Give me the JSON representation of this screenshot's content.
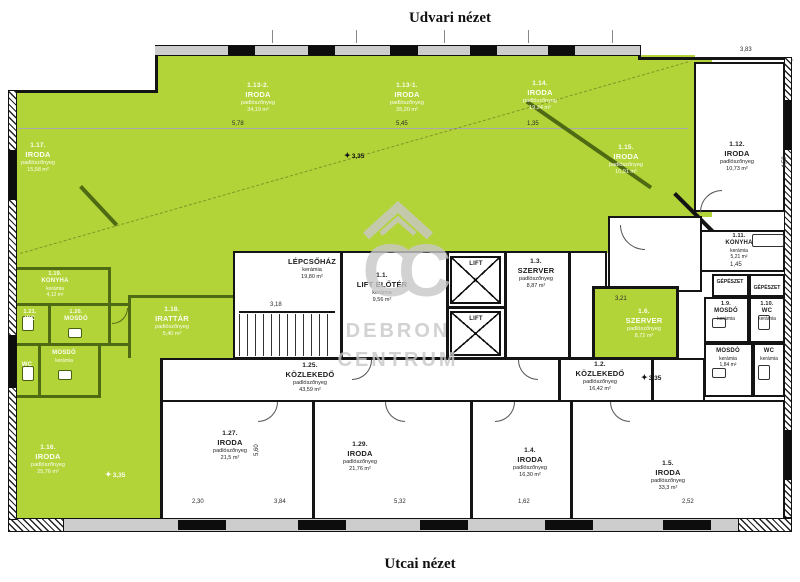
{
  "titles": {
    "top": "Udvari nézet",
    "bottom": "Utcai nézet"
  },
  "watermark": {
    "line1": "DEBRON",
    "line2": "CENTRUM",
    "monogram": "CC"
  },
  "colors": {
    "highlight_green": "#b3d438",
    "wall_black": "#141414",
    "wall_green": "#4e6a12",
    "watermark_gray": "#c7c7c7"
  },
  "level": "3,35",
  "rooms": [
    {
      "id": "1.17.",
      "name": "IRODA",
      "floor": "padlószőnyeg",
      "area": "15,58 m²"
    },
    {
      "id": "1.13-2.",
      "name": "IRODA",
      "floor": "padlószőnyeg",
      "area": "34,19 m²"
    },
    {
      "id": "1.13-1.",
      "name": "IRODA",
      "floor": "padlószőnyeg",
      "area": "35,20 m²"
    },
    {
      "id": "1.14.",
      "name": "IRODA",
      "floor": "padlószőnyeg",
      "area": "19,24 m²"
    },
    {
      "id": "1.15.",
      "name": "IRODA",
      "floor": "padlószőnyeg",
      "area": "10,91 m²"
    },
    {
      "id": "1.12.",
      "name": "IRODA",
      "floor": "padlószőnyeg",
      "area": "10,73 m²"
    },
    {
      "id": "1.11.",
      "name": "KONYHA",
      "floor": "kerámia",
      "area": "5,21 m²"
    },
    {
      "id": "1.19.",
      "name": "KONYHA",
      "floor": "kerámia",
      "area": "4,12 m²"
    },
    {
      "id": "1.21.",
      "name": "WC",
      "floor": "kerámia",
      "area": ""
    },
    {
      "id": "1.20.",
      "name": "MOSDÓ",
      "floor": "kerámia",
      "area": ""
    },
    {
      "id": "1.22.",
      "name": "MOSDÓ",
      "floor": "kerámia",
      "area": ""
    },
    {
      "id": "1.23.",
      "name": "WC",
      "floor": "kerámia",
      "area": ""
    },
    {
      "id": "1.18.",
      "name": "IRATTÁR",
      "floor": "padlószőnyeg",
      "area": "5,40 m²"
    },
    {
      "id": "",
      "name": "LÉPCSŐHÁZ",
      "floor": "kerámia",
      "area": "19,80 m²"
    },
    {
      "id": "1.1.",
      "name": "LIFT ELŐTÉR",
      "floor": "kerámia",
      "area": "9,56 m²"
    },
    {
      "id": "",
      "name": "LIFT",
      "floor": "",
      "area": ""
    },
    {
      "id": "",
      "name": "LIFT",
      "floor": "",
      "area": ""
    },
    {
      "id": "1.3.",
      "name": "SZERVER",
      "floor": "padlószőnyeg",
      "area": "8,87 m²"
    },
    {
      "id": "1.6.",
      "name": "SZERVER",
      "floor": "padlószőnyeg",
      "area": "8,72 m²"
    },
    {
      "id": "1.25.",
      "name": "KÖZLEKEDŐ",
      "floor": "padlószőnyeg",
      "area": "43,59 m²"
    },
    {
      "id": "1.2.",
      "name": "KÖZLEKEDŐ",
      "floor": "padlószőnyeg",
      "area": "16,42 m²"
    },
    {
      "id": "1.27.",
      "name": "IRODA",
      "floor": "padlószőnyeg",
      "area": "21,5 m²"
    },
    {
      "id": "1.29.",
      "name": "IRODA",
      "floor": "padlószőnyeg",
      "area": "21,76 m²"
    },
    {
      "id": "1.4.",
      "name": "IRODA",
      "floor": "padlószőnyeg",
      "area": "16,30 m²"
    },
    {
      "id": "1.5.",
      "name": "IRODA",
      "floor": "padlószőnyeg",
      "area": "33,3 m²"
    },
    {
      "id": "1.16.",
      "name": "IRODA",
      "floor": "padlószőnyeg",
      "area": "25,76 m²"
    },
    {
      "id": "1.9.",
      "name": "MOSDÓ",
      "floor": "kerámia",
      "area": ""
    },
    {
      "id": "1.10.",
      "name": "WC",
      "floor": "kerámia",
      "area": ""
    },
    {
      "id": "1.8.",
      "name": "MOSDÓ",
      "floor": "kerámia",
      "area": "1,84 m²"
    },
    {
      "id": "1.7.",
      "name": "WC",
      "floor": "kerámia",
      "area": ""
    },
    {
      "id": "",
      "name": "GÉPÉSZET",
      "floor": "",
      "area": ""
    },
    {
      "id": "",
      "name": "GÉPÉSZET",
      "floor": "",
      "area": ""
    }
  ],
  "dims": [
    "5,78",
    "5,45",
    "1,35",
    "3,83",
    "4,59",
    "1,45",
    "3,21",
    "3,18",
    "5,60",
    "2,30",
    "3,84",
    "5,32",
    "1,62",
    "2,52"
  ]
}
